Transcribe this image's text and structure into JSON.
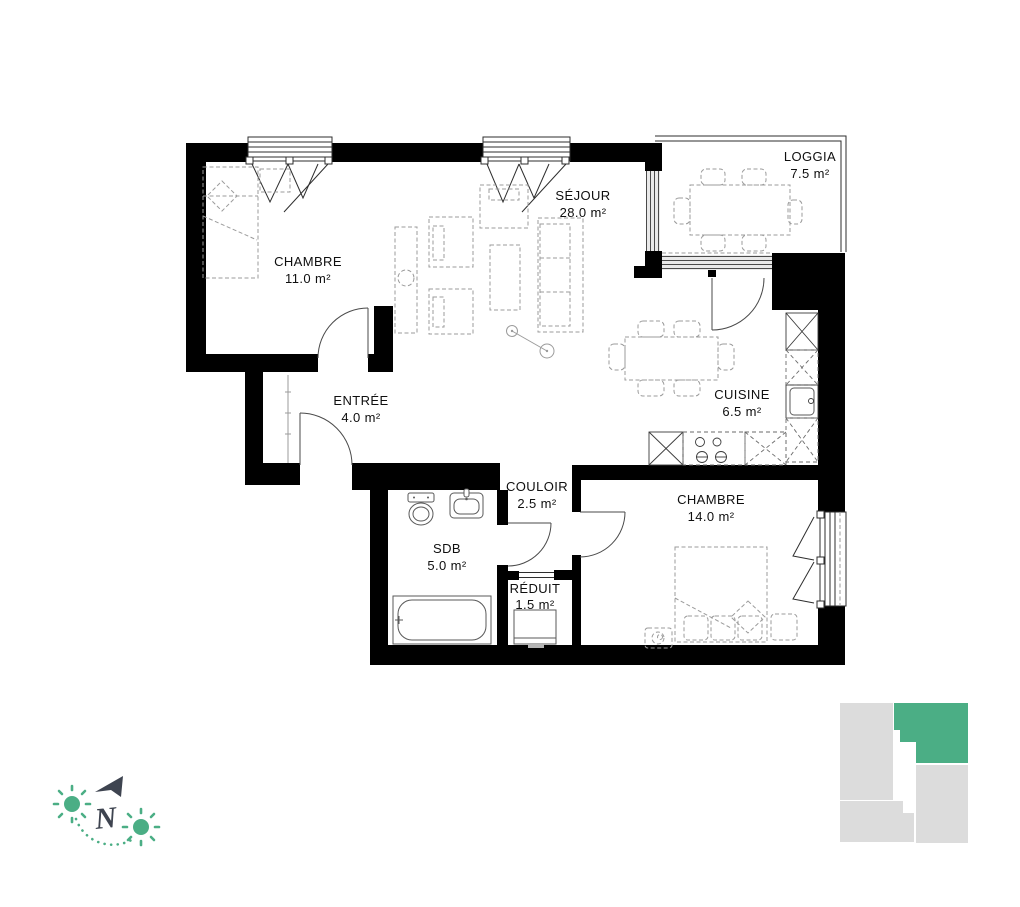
{
  "plan": {
    "rooms": [
      {
        "name": "CHAMBRE",
        "area": "11.0 m²"
      },
      {
        "name": "SÉJOUR",
        "area": "28.0 m²"
      },
      {
        "name": "LOGGIA",
        "area": "7.5 m²"
      },
      {
        "name": "CUISINE",
        "area": "6.5 m²"
      },
      {
        "name": "ENTRÉE",
        "area": "4.0 m²"
      },
      {
        "name": "COULOIR",
        "area": "2.5 m²"
      },
      {
        "name": "SDB",
        "area": "5.0 m²"
      },
      {
        "name": "RÉDUIT",
        "area": "1.5 m²"
      },
      {
        "name": "CHAMBRE",
        "area": "14.0 m²"
      }
    ],
    "compass": {
      "north_label": "N"
    },
    "colors": {
      "accent_green": "#4bae85",
      "compass_slate": "#3e4450",
      "minimap_gray": "#dcdcdc",
      "wall_black": "#000000"
    }
  }
}
